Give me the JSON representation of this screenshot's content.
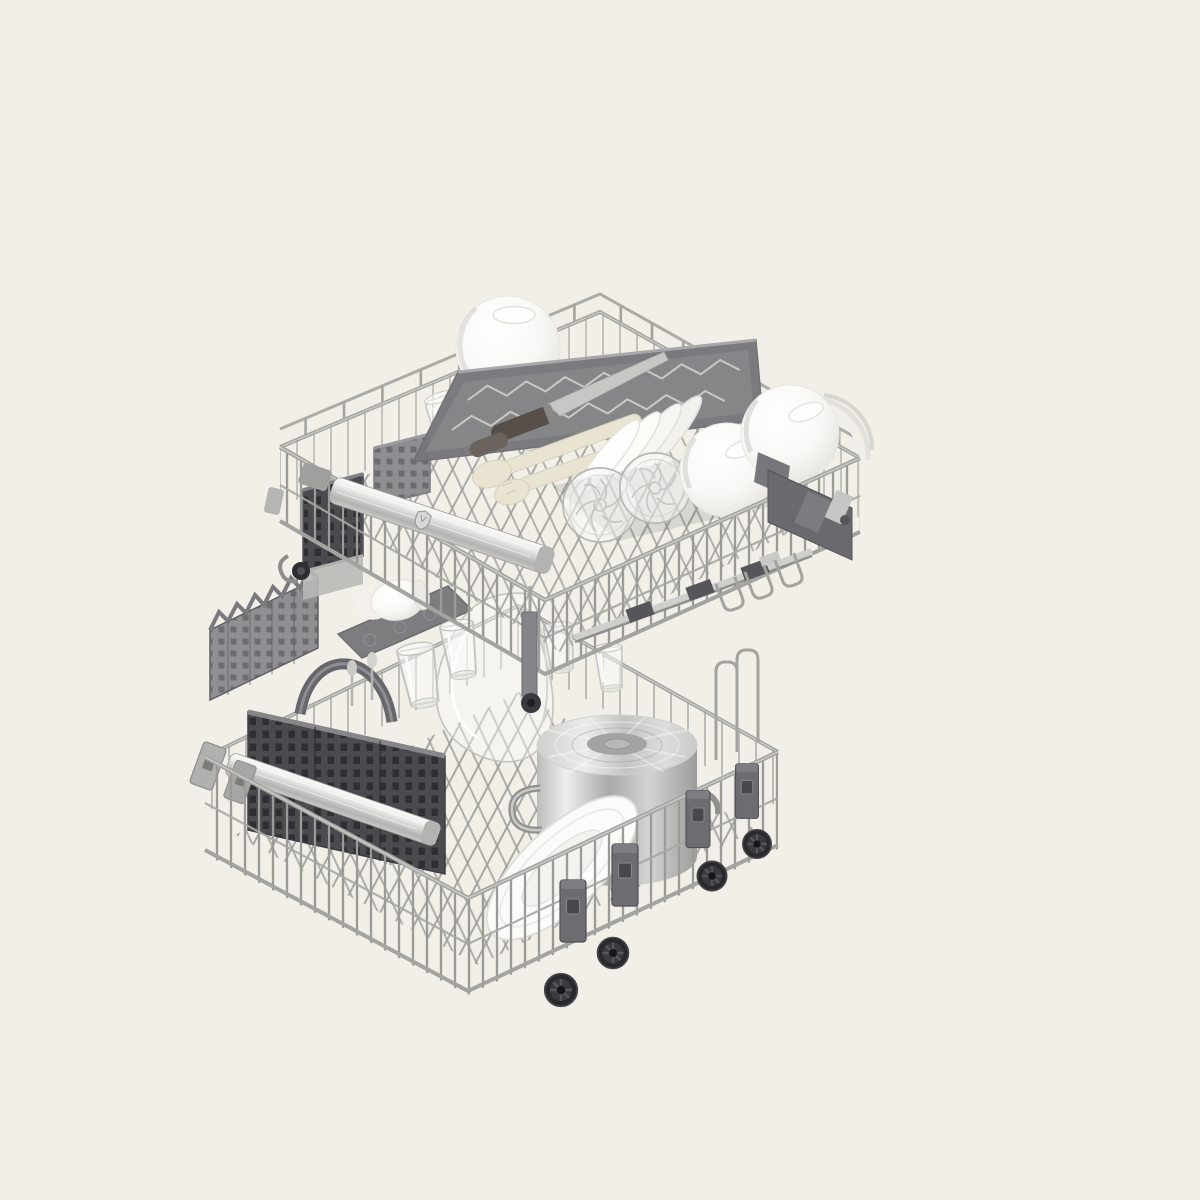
{
  "image": {
    "kind": "product-photo-render",
    "subject": "dishwasher-baskets-loaded-with-dishes",
    "background": "#f1efe8",
    "palette": {
      "bg": "#f1efe8",
      "wire_light": "#c9c9c6",
      "wire_mid": "#a3a3a0",
      "wire_dark": "#858582",
      "plastic_dark": "#4a4a4f",
      "plastic_mid": "#77777b",
      "plastic_light": "#b0b0ae",
      "steel_light": "#efefed",
      "steel_mid": "#c9c9c7",
      "steel_dark": "#9b9b99",
      "white_dish": "#ffffff",
      "dish_shadow": "#dcdbd6",
      "cream_utensil": "#e8e4d1",
      "knife_handle": "#57504a",
      "wheel_black": "#2a2a2d",
      "glass_line": "#c3c3bf"
    },
    "objects": [
      "upper-basket",
      "third-level-cutlery-tray",
      "chef-knife",
      "serving-utensils",
      "glass-mugs",
      "white-bowl-top",
      "white-bowl-right-1",
      "white-bowl-right-2",
      "plate-stack",
      "large-dinner-plates",
      "crystal-dessert-bowls",
      "small-mesh-basket",
      "dark-mesh-box",
      "upper-handle-bar",
      "brand-emblem",
      "height-adjuster-mechanism",
      "telescopic-rail",
      "caster-wheel",
      "lower-basket",
      "fold-down-comb",
      "fold-down-shelf",
      "white-mug",
      "glass-salad-bowl",
      "glass-tumblers",
      "cutlery-basket",
      "cutlery-basket-handle",
      "lower-handle-bar",
      "clip-plates",
      "stock-pot",
      "leaning-plate",
      "mounting-tabs",
      "roller-wheels",
      "tall-wire-loops",
      "hanging-bracket"
    ]
  }
}
